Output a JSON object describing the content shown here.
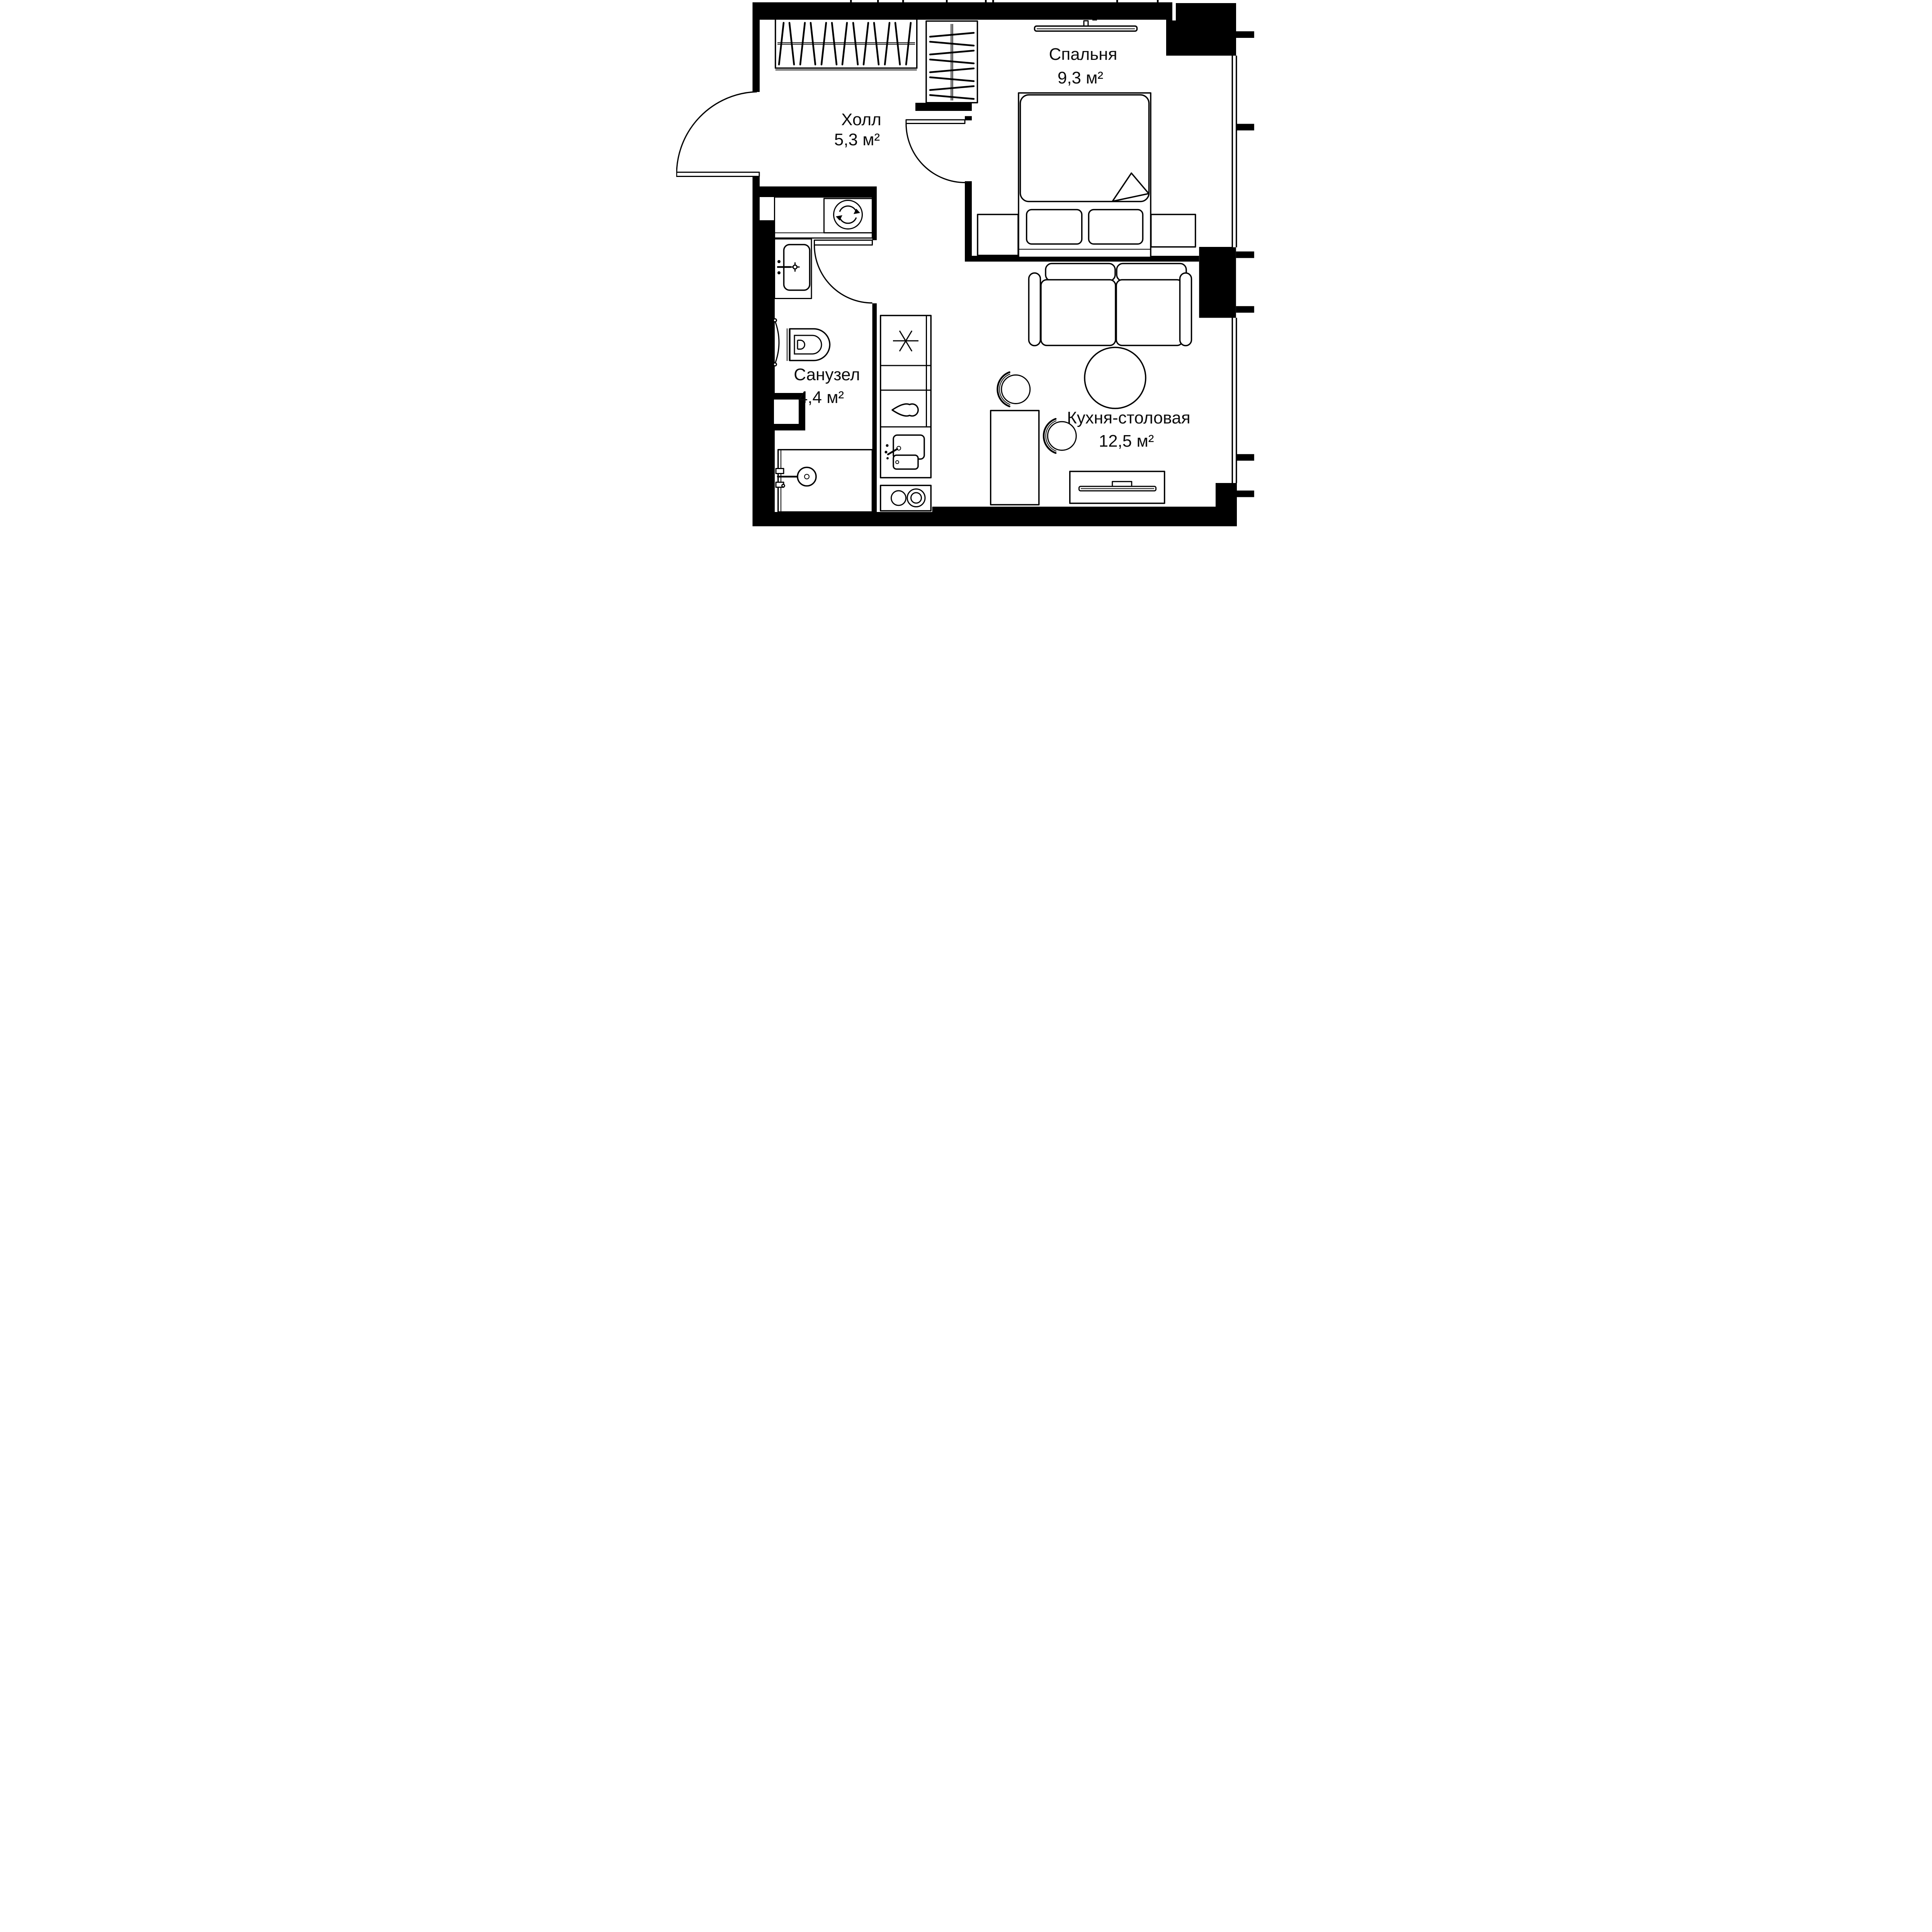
{
  "meta": {
    "type": "apartment-floor-plan",
    "background_color": "#ffffff",
    "ink_color": "#000000",
    "language": "ru"
  },
  "rooms": [
    {
      "id": "bedroom",
      "name": "Спальня",
      "area": "9,3 м²"
    },
    {
      "id": "hall",
      "name": "Холл",
      "area": "5,3 м²"
    },
    {
      "id": "bathroom",
      "name": "Санузел",
      "area": "4,4 м²"
    },
    {
      "id": "kitchen_dining",
      "name": "Кухня-столовая",
      "area": "12,5 м²"
    }
  ],
  "fixtures": [
    "wardrobe-with-hangers-horizontal",
    "wardrobe-with-hangers-vertical",
    "wall-mounted-tv",
    "double-bed-with-pillows",
    "nightstand-left",
    "nightstand-right",
    "two-seat-sofa",
    "round-dining-table",
    "chair",
    "desk-table",
    "tv-console",
    "kitchen-fridge",
    "kitchen-cabinet",
    "kitchen-sink",
    "kitchen-hob-two-burners",
    "washing-machine",
    "bathroom-counter",
    "bathroom-sink",
    "wall-hung-toilet",
    "towel-rail",
    "shower-tray-with-drain",
    "vent-shaft",
    "entrance-door",
    "bedroom-door",
    "bathroom-door",
    "window-bedroom",
    "window-living"
  ]
}
